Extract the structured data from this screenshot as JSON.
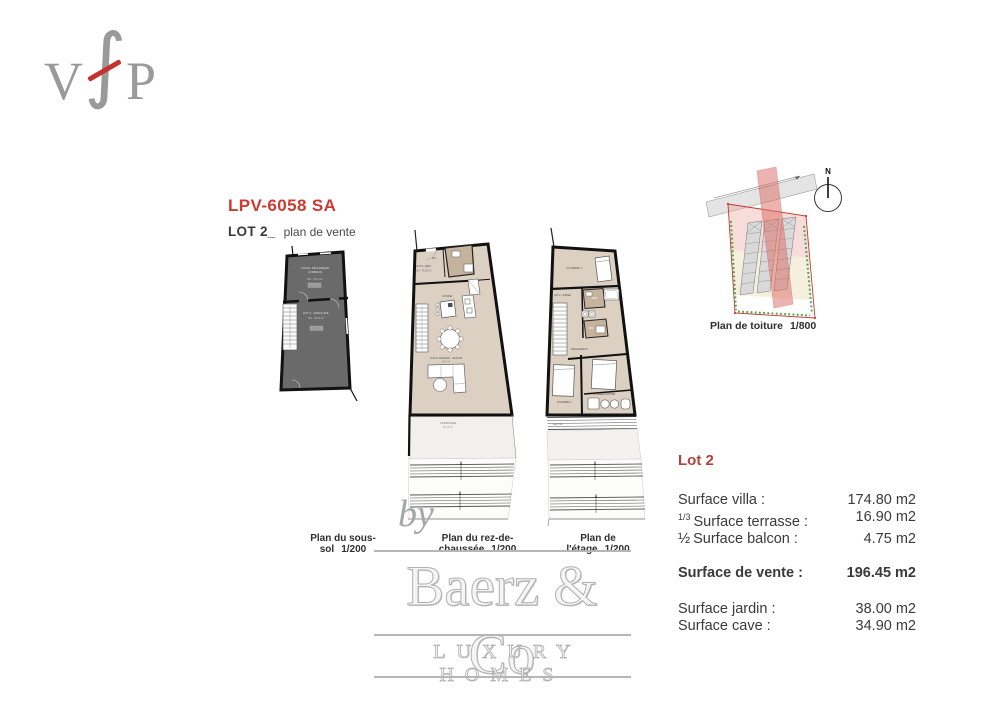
{
  "logo": {
    "v": "V",
    "f": "∫",
    "p": "P"
  },
  "header": {
    "title": "LPV-6058 SA",
    "lot": "LOT 2_",
    "subtitle": "plan de vente"
  },
  "plans": {
    "sous_sol": {
      "caption": "Plan du sous-sol",
      "scale": "1/200",
      "room_top_line1": "LOCAL TECHNIQUE",
      "room_top_line2": "COMMUN",
      "room_top_area": "SU : 13.4 m²",
      "room_bottom": "LOT 2 - SOUS-SOL",
      "room_bottom_area": "SU : 34.9 m²"
    },
    "rdc": {
      "caption": "Plan du rez-de-chaussée",
      "scale": "1/200",
      "side_label": "LOT 2 - RDC",
      "side_area": "SU : 76.35 m²",
      "wc": "WC",
      "kitchen": "CUISINE",
      "living": "CUIS & MANGER - SEJOUR",
      "living_area": "40.7 m²",
      "terrace": "TERRASSE",
      "terrace_area": "50.70 m²"
    },
    "etage": {
      "caption": "Plan de l'étage",
      "scale": "1/200",
      "side_label": "LOT 2 - ETAGE",
      "bedroom3": "CHAMBRE 3",
      "sdb": "SDB",
      "sde": "SDE",
      "hall": "DEGAGEMENT",
      "bedroom2": "CHAMBRE 2",
      "master": "CHAMBRE MASTER",
      "balcony": "BALCON"
    },
    "toiture": {
      "caption": "Plan de toiture",
      "scale": "1/800",
      "north": "N"
    }
  },
  "watermark": {
    "by": "by",
    "brand": "Baerz & Co",
    "tagline": "LUXURY HOMES"
  },
  "surfaces": {
    "title": "Lot 2",
    "rows": [
      {
        "prefix": "",
        "label": "Surface villa :",
        "value": "174.80 m2"
      },
      {
        "prefix": "1/3",
        "label": "Surface terrasse :",
        "value": "16.90 m2"
      },
      {
        "prefix": "½",
        "label": "Surface balcon :",
        "value": "4.75 m2"
      }
    ],
    "total": {
      "label": "Surface de vente :",
      "value": "196.45 m2"
    },
    "extras": [
      {
        "label": "Surface jardin :",
        "value": "38.00 m2"
      },
      {
        "label": "Surface cave :",
        "value": "34.90 m2"
      }
    ]
  },
  "colors": {
    "accent_red": "#cd3a31",
    "plan_beige": "#dcd0c2",
    "plan_dark": "#6a6a6a",
    "wet_room": "#c6b39e"
  }
}
